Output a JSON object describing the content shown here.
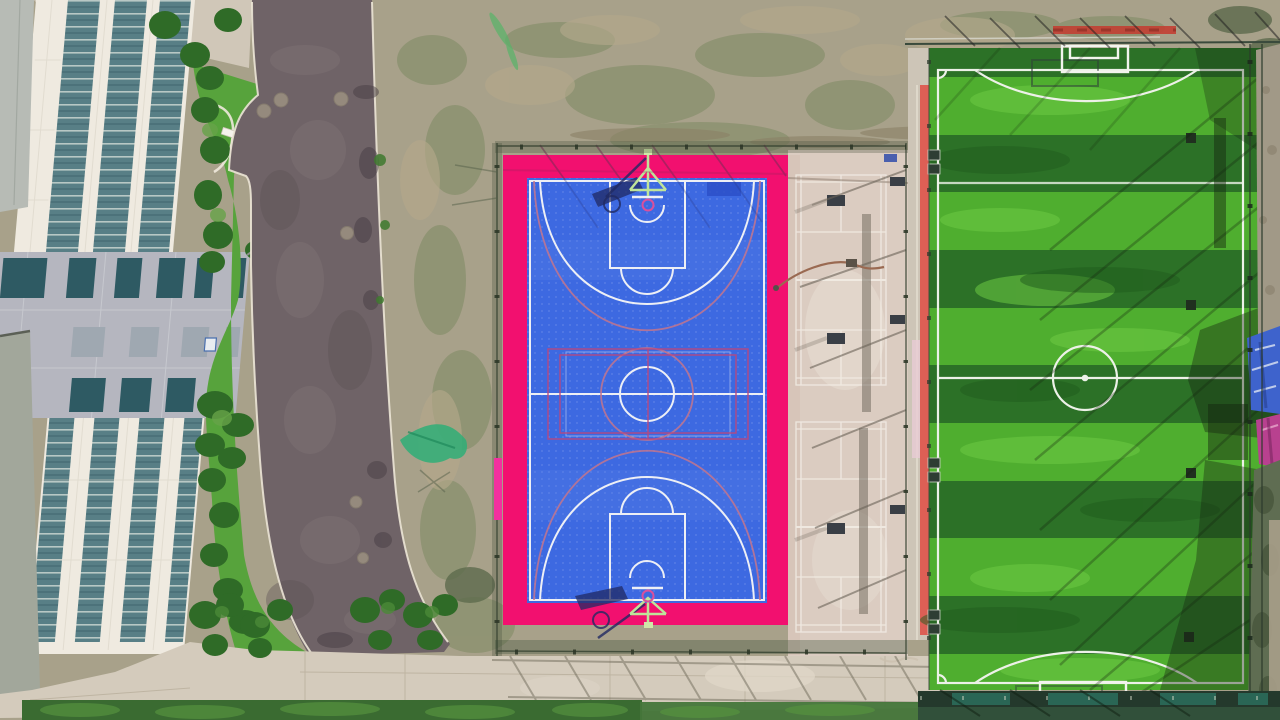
{
  "meta": {
    "title": "Aerial drone photograph of a campus sports complex, top-down view",
    "width_px": 1280,
    "height_px": 720
  },
  "scene": {
    "building": {
      "label": "school building with glass curtain-wall strips and grey panelled wing"
    },
    "roof": {
      "label": "grey roof slab"
    },
    "road": {
      "label": "asphalt access road with manhole covers",
      "manhole_count": 6
    },
    "lawn": {
      "label": "lawn with shrubs and trees beside building"
    },
    "person": {
      "label": "pedestrian at lawn edge"
    },
    "scrub": {
      "label": "bare scrubby ground between road and courts"
    },
    "basketball_court": {
      "label": "blue basketball court with magenta apron, volleyball overlay lines and two hoops casting shadows"
    },
    "multiuse_area": {
      "label": "beige badminton multi-use courts with benches and garden hose"
    },
    "pavement": {
      "label": "concrete walkway with fence shadows"
    },
    "soccer_field": {
      "label": "striped artificial-turf football pitch with goals, centre circle and fence shadows"
    },
    "umbrellas": {
      "label": "blue and magenta canopies at the right fence"
    },
    "hedge": {
      "label": "hedge strip along the bottom edge"
    }
  },
  "colors": {
    "scrub_base": "#a8a18a",
    "road_asphalt": "#6f6367",
    "curb_white": "#ece5d6",
    "concrete": "#d4cbbc",
    "roof_grey": "#b7bbb5",
    "slab_grey": "#a2a79b",
    "facade_white": "#efeae0",
    "wing_grey": "#b5b6bf",
    "window_dark": "#2e5a63",
    "window_mid": "#9fa8b1",
    "lawn_green": "#57a33c",
    "bush_dark": "#2f6b27",
    "court_pink": "#f2106f",
    "court_blue": "#3d69e1",
    "court_line": "#edeff5",
    "overlay_magenta": "#b8487f",
    "overlay_red": "#c4758d",
    "hoop_stand": "#bfe49a",
    "hoop_ring": "#d9509c",
    "shadow_navy": "#202a63",
    "net_green": "#2fae77",
    "multiuse_beige": "#dbccc1",
    "multiuse_line": "#f3eee6",
    "turf_light": "#4fae2f",
    "turf_dark": "#2c7127",
    "field_line": "#edf1e8",
    "goal_shadow": "#2f4038",
    "red_strip": "#dd5f55",
    "red_bar": "#c23f33",
    "umbrella_blue": "#3e63cc",
    "umbrella_magenta": "#b8418f",
    "hedge_green": "#3a6b31",
    "band_dark": "#24392c",
    "teal_band": "#2c6e5d"
  }
}
